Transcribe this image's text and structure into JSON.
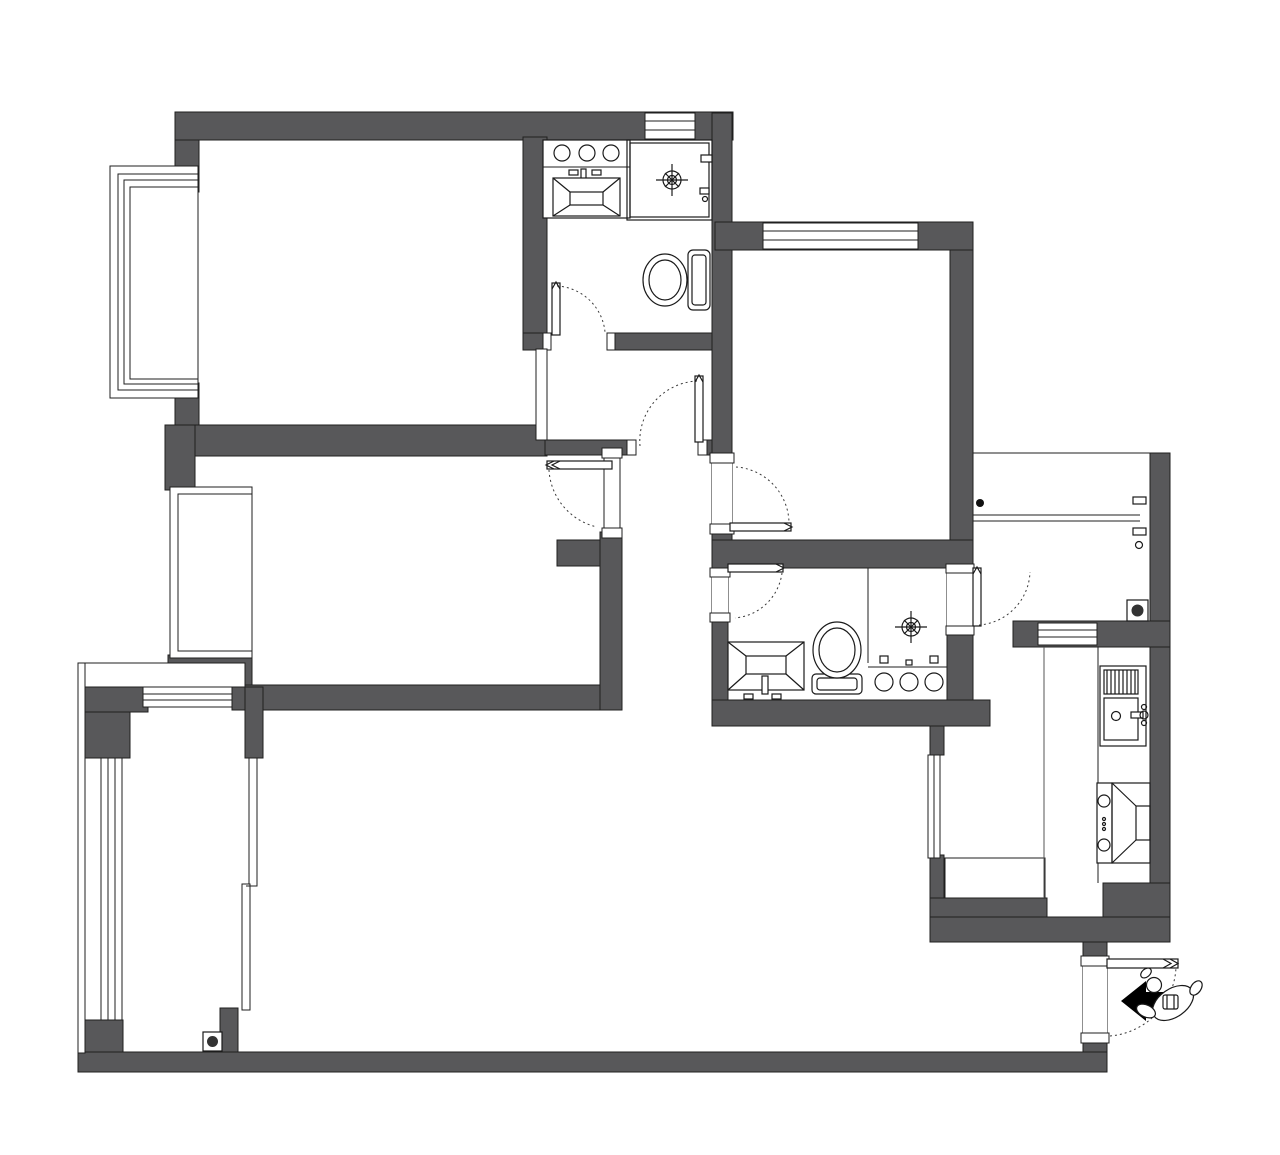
{
  "meta": {
    "title": "Apartment floor plan line drawing (no text labels)",
    "drawing_type": "architectural-floor-plan",
    "label_text": ""
  },
  "colors": {
    "wall": "#58585a",
    "outline": "#1f1f1f",
    "fixture_line": "#1a1a1a",
    "arc": "#3a3a3a",
    "accent_black": "#000000",
    "drain_fill": "#333333",
    "background": "#ffffff"
  },
  "elements": {
    "icons": [
      "bay-window-icon",
      "casement-window-icon",
      "sliding-door-icon",
      "door-swing-icon",
      "washbasin-icon",
      "toilet-icon",
      "shower-floor-drain-icon",
      "vanity-counter-icon",
      "kitchen-sink-icon",
      "gas-stove-icon",
      "range-hood-icon",
      "clothes-drying-rack-icon",
      "floor-drain-icon",
      "entry-direction-arrow-icon",
      "person-figure-icon",
      "wall-niche-icon"
    ],
    "counts": {
      "door_swings": 7,
      "toilets": 2,
      "washbasins": 2,
      "kitchen_sinks": 1,
      "stoves": 1,
      "floor_drains": 2,
      "shower_drains": 2,
      "windows": 8,
      "sliding_doors": 1,
      "bay_windows": 2
    }
  }
}
